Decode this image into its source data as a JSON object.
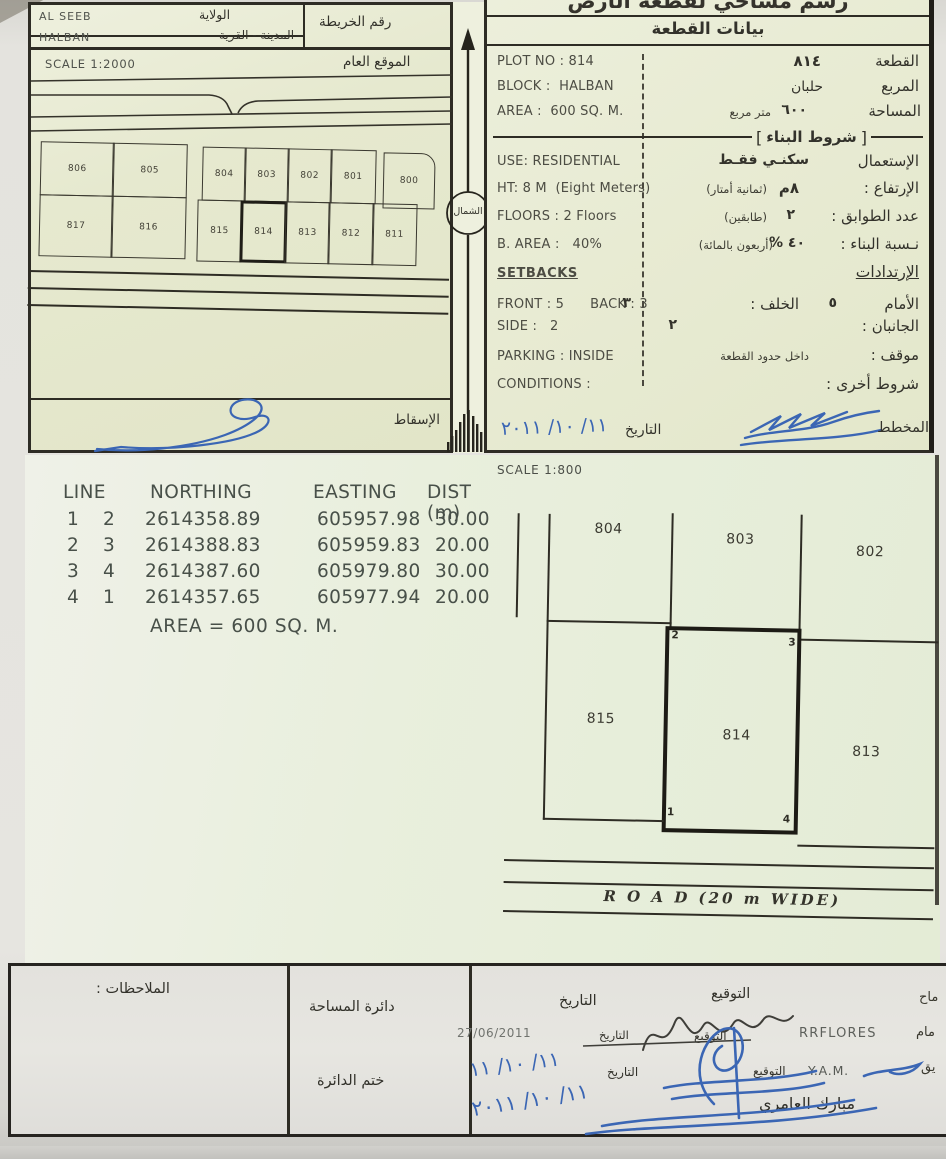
{
  "sheet": {
    "title": "رسم مساحي لقطعة الأرض",
    "plot_data_header": "بيانات القطعة"
  },
  "header_left": {
    "wilaya_value": "AL SEEB",
    "wilaya_label": "الولاية",
    "city_value": "HALBAN",
    "city_label": "المدينة - القرية",
    "map_no_label": "رقم الخريطة"
  },
  "location_map": {
    "scale": "SCALE 1:2000",
    "title": "الموقع العام",
    "projection_label": "الإسقاط",
    "plots_row1": [
      "806",
      "805",
      "804",
      "803",
      "802",
      "801",
      "800"
    ],
    "plots_row2": [
      "817",
      "816",
      "815",
      "814",
      "813",
      "812",
      "811"
    ]
  },
  "north_label": "الشمال",
  "plot_data": {
    "plot_no_en": "PLOT NO : 814",
    "plot_label": "القطعة",
    "plot_value": "٨١٤",
    "block_en": "BLOCK :  HALBAN",
    "block_label": "المربع",
    "block_value": "حلبان",
    "area_en": "AREA :  600 SQ. M.",
    "area_label": "المساحة",
    "area_value": "٦٠٠",
    "area_unit": "متر مربع"
  },
  "building": {
    "header": "شروط البناء",
    "use_en": "USE: RESIDENTIAL",
    "use_label": "الإستعمال",
    "use_value": "سكنـي فقـط",
    "height_en": "HT: 8 M  (Eight Meters)",
    "height_label": "الإرتفاع :",
    "height_value": "٨م",
    "height_note": "(ثمانية أمتار)",
    "floors_en": "FLOORS : 2 Floors",
    "floors_label": "عدد الطوابق :",
    "floors_value": "٢",
    "floors_note": "(طابقين)",
    "barea_en": "B. AREA :   40%",
    "barea_label": "نـسبة البناء :",
    "barea_value": "٤٠ %",
    "barea_note": "(أربعون بالمائة)",
    "setbacks_en": "SETBACKS",
    "setbacks_label": "الإرتدادات",
    "front_en": "FRONT : 5      BACK : 3",
    "front_label": "الأمام",
    "front_value": "٥",
    "back_label": "الخلف :",
    "back_value": "٣",
    "side_en": "SIDE :   2",
    "side_label": "الجانبان :",
    "side_value": "٢",
    "parking_en": "PARKING : INSIDE",
    "parking_label": "موقف :",
    "parking_value": "داخل حدود القطعة",
    "conditions_en": "CONDITIONS :",
    "conditions_label": "شروط أخرى :",
    "date_label": "التاريخ",
    "date_value": "١١/ ١٠/ ٢٠١١",
    "planner_label": "المخطط"
  },
  "coords": {
    "col_line": "LINE",
    "col_northing": "NORTHING",
    "col_easting": "EASTING",
    "col_dist": "DIST (m)",
    "rows": [
      {
        "from": "1",
        "to": "2",
        "northing": "2614358.89",
        "easting": "605957.98",
        "dist": "30.00"
      },
      {
        "from": "2",
        "to": "3",
        "northing": "2614388.83",
        "easting": "605959.83",
        "dist": "20.00"
      },
      {
        "from": "3",
        "to": "4",
        "northing": "2614387.60",
        "easting": "605979.80",
        "dist": "30.00"
      },
      {
        "from": "4",
        "to": "1",
        "northing": "2614357.65",
        "easting": "605977.94",
        "dist": "20.00"
      }
    ],
    "area_text": "AREA = 600 SQ. M."
  },
  "detail_map": {
    "scale": "SCALE 1:800",
    "plots_top": [
      "804",
      "803",
      "802"
    ],
    "plots_bottom": [
      "815",
      "814",
      "813"
    ],
    "corner_1": "1",
    "corner_2": "2",
    "corner_3": "3",
    "corner_4": "4",
    "road_text": "R O A D (20 m WIDE)"
  },
  "footer": {
    "notes_label": "الملاحظات :",
    "dept_label": "دائرة المساحة",
    "stamp_label": "ختم الدائرة",
    "sign_header": "التوقيع",
    "date_header": "التاريخ",
    "surveyor_role_cut": "ماح",
    "draftsman_role_cut": "مام",
    "checker_role_cut": "يق",
    "draftsman_name": "RRFLORES",
    "draftsman_sign_label": "التوقيع",
    "draftsman_date_label": "التاريخ",
    "draftsman_date": "27/06/2011",
    "checker_name": "Y.A.M.",
    "checker_sign_label": "التوقيع",
    "checker_date_label": "التاريخ",
    "checker_date": "١١/ ١٠/ ١١",
    "approver_name": "مبارك العامري",
    "approver_date": "١١/ ١٠/ ٢٠١١"
  }
}
